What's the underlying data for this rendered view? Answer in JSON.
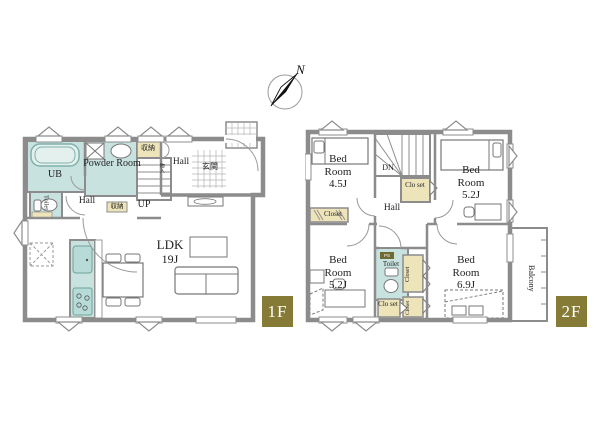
{
  "meta": {
    "type": "residential floor plan, 2 storeys"
  },
  "palette": {
    "wall": "#8c8c8c",
    "room_teal": "#c8e2df",
    "closet_beige": "#eee4ba",
    "badge_olive": "#857b37"
  },
  "compass": {
    "north": "N"
  },
  "floor1": {
    "badge": "1F",
    "labels": {
      "ub": "UB",
      "powder_room": "Powder Room",
      "toilet": "Toilet",
      "hall_lower": "Hall",
      "storage_hall": "収納",
      "up": "UP",
      "storage_top": "収納",
      "hall_upper": "Hall",
      "storage_small": "物入",
      "entrance": "玄関",
      "ldk_name": "LDK",
      "ldk_size": "19J"
    }
  },
  "floor2": {
    "badge": "2F",
    "labels": {
      "dn": "DN",
      "hall": "Hall",
      "toilet": "Toilet",
      "toilet_badge": "PS",
      "balcony": "Balcony",
      "bedroom_nw_name": "Bed Room",
      "bedroom_nw_size": "4.5J",
      "bedroom_ne_name": "Bed Room",
      "bedroom_ne_size": "5.2J",
      "bedroom_sw_name": "Bed Room",
      "bedroom_sw_size": "5.2J",
      "bedroom_se_name": "Bed Room",
      "bedroom_se_size": "6.9J",
      "closet_nw": "Closet",
      "closet_stairs": "Clo set",
      "closet_toilet": "Clo set",
      "closet_east_upper": "Closet",
      "closet_east_lower": "Closet"
    }
  }
}
